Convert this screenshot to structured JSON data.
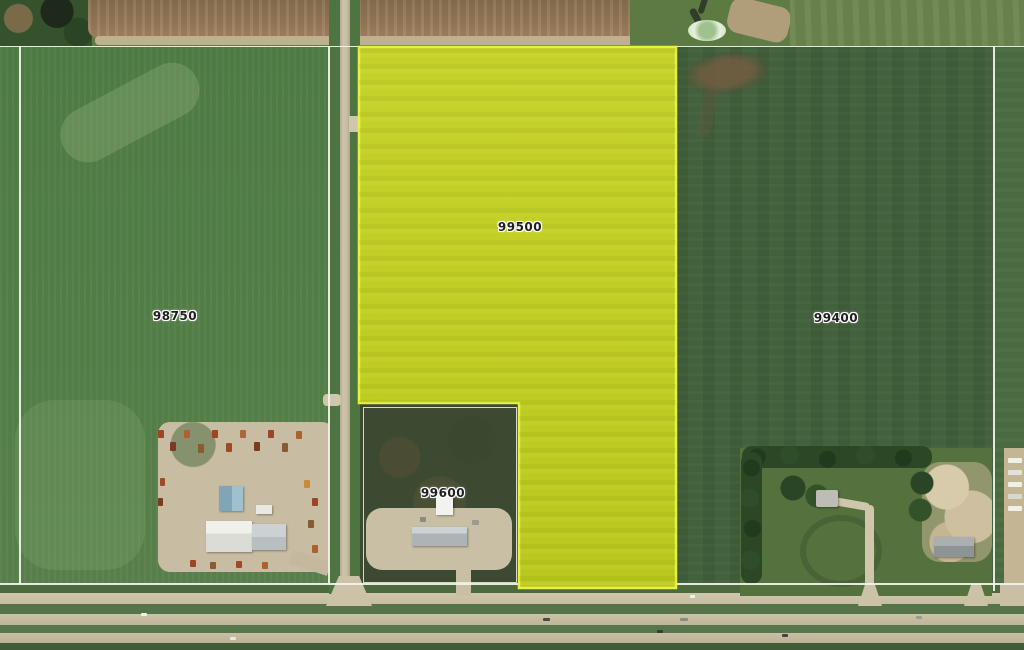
{
  "map": {
    "description": "Aerial parcel map with highlighted parcel",
    "parcels": [
      {
        "id": "98750",
        "label": "98750",
        "highlighted": false
      },
      {
        "id": "99500",
        "label": "99500",
        "highlighted": true
      },
      {
        "id": "99400",
        "label": "99400",
        "highlighted": false
      },
      {
        "id": "99600",
        "label": "99600",
        "highlighted": false
      }
    ],
    "highlight": {
      "fill": "#c5d122",
      "stroke": "#e7f13e",
      "fill_opacity": "0.96"
    },
    "colors": {
      "boundary_line": "#f0f0e6",
      "label_text": "#202020",
      "label_halo": "#ffffff",
      "field_green": "#507c46",
      "field_dark_green": "#42613c",
      "tilled_brown": "#8f7354",
      "road_tan": "#c6bda3",
      "tree_green": "#2c4726"
    }
  }
}
